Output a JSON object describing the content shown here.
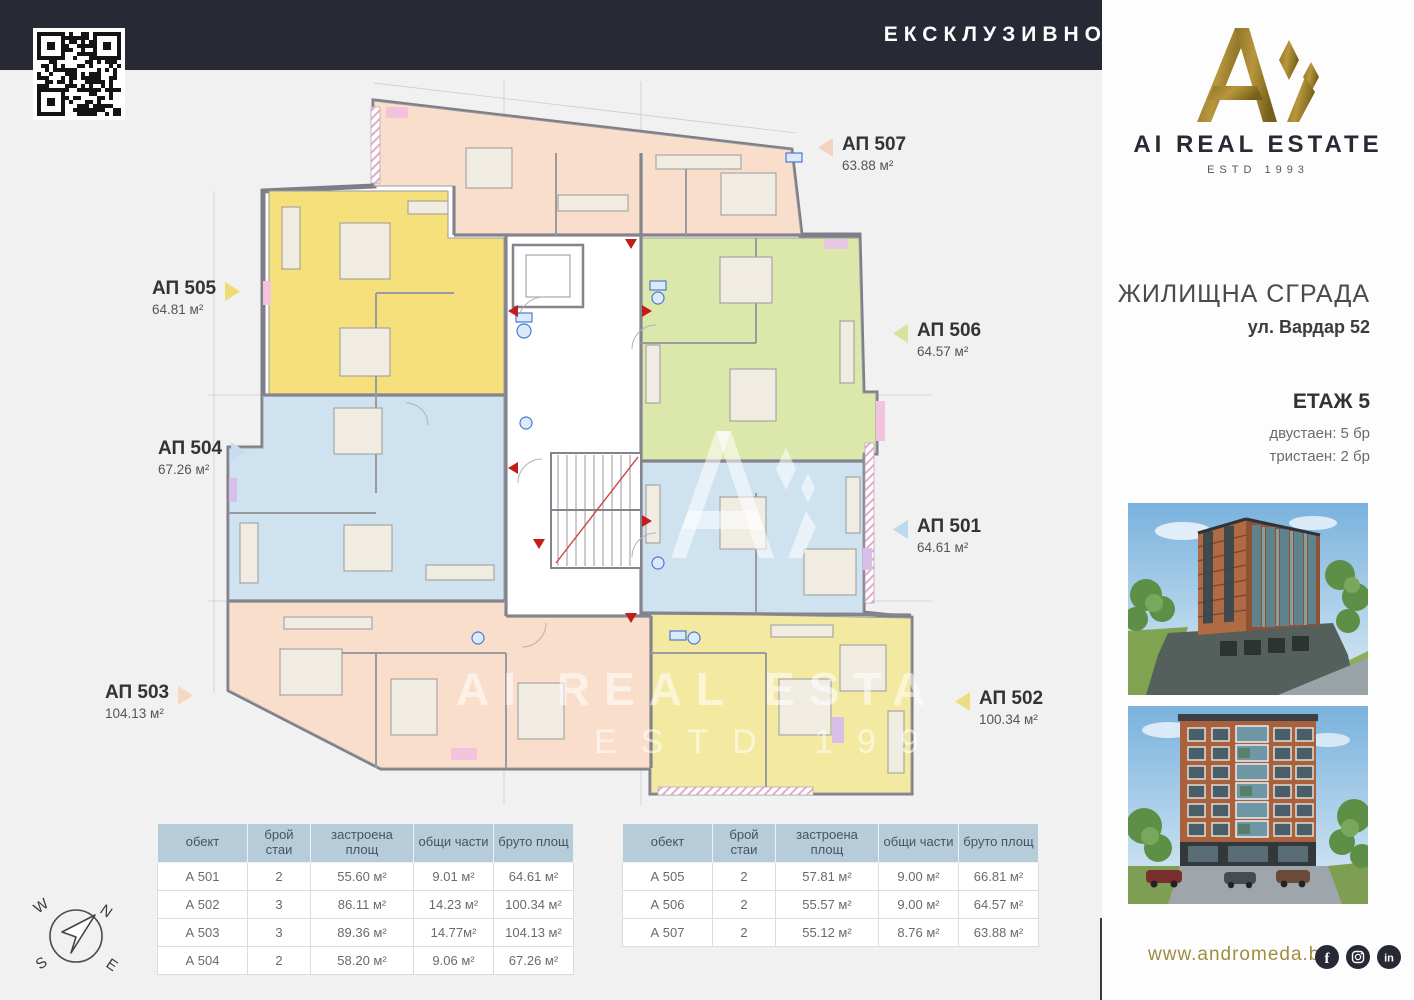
{
  "header": {
    "exclusive": "ЕКСКЛУЗИВНО ОТ"
  },
  "brand": {
    "name": "AI REAL ESTATE",
    "estd": "ESTD 1993",
    "gold": "#9a7d2c",
    "navy": "#272935"
  },
  "project": {
    "building": "ЖИЛИЩНА СГРАДА",
    "address": "ул. Вардар 52",
    "floor": "ЕТАЖ 5",
    "mix": [
      {
        "label": "двустаен: 5 бр"
      },
      {
        "label": "тристаен: 2 бр"
      }
    ]
  },
  "apartments": [
    {
      "id": "АП 507",
      "area": "63.88 м²",
      "color": "#f2d4be",
      "zone": "#f9decb"
    },
    {
      "id": "АП 505",
      "area": "64.81 м²",
      "color": "#f0dc72",
      "zone": "#f5e07c"
    },
    {
      "id": "АП 504",
      "area": "67.26 м²",
      "color": "#c6dcee",
      "zone": "#cfe2ef"
    },
    {
      "id": "АП 503",
      "area": "104.13 м²",
      "color": "#f4d8c2",
      "zone": "#f9decb"
    },
    {
      "id": "АП 506",
      "area": "64.57 м²",
      "color": "#d9e19c",
      "zone": "#dbe7ab"
    },
    {
      "id": "АП 501",
      "area": "64.61 м²",
      "color": "#bed8ec",
      "zone": "#cfe2ef"
    },
    {
      "id": "АП 502",
      "area": "100.34 м²",
      "color": "#ecdc84",
      "zone": "#f3e9a0"
    }
  ],
  "tables": [
    {
      "headers": [
        "обект",
        "брой стаи",
        "застроена площ",
        "общи части",
        "бруто площ"
      ],
      "rows": [
        [
          "А 501",
          "2",
          "55.60 м²",
          "9.01 м²",
          "64.61 м²"
        ],
        [
          "А 502",
          "3",
          "86.11 м²",
          "14.23 м²",
          "100.34 м²"
        ],
        [
          "А 503",
          "3",
          "89.36 м²",
          "14.77м²",
          "104.13 м²"
        ],
        [
          "А 504",
          "2",
          "58.20 м²",
          "9.06 м²",
          "67.26 м²"
        ]
      ]
    },
    {
      "headers": [
        "обект",
        "брой стаи",
        "застроена площ",
        "общи части",
        "бруто площ"
      ],
      "rows": [
        [
          "А 505",
          "2",
          "57.81 м²",
          "9.00 м²",
          "66.81 м²"
        ],
        [
          "А 506",
          "2",
          "55.57 м²",
          "9.00 м²",
          "64.57 м²"
        ],
        [
          "А 507",
          "2",
          "55.12 м²",
          "8.76 м²",
          "63.88 м²"
        ]
      ]
    }
  ],
  "watermark": {
    "name": "AI REAL ESTATE",
    "estd": "ESTD 1993"
  },
  "compass": {
    "n": "N",
    "e": "E",
    "s": "S",
    "w": "W"
  },
  "footer": {
    "website": "www.andromeda.bg",
    "socials": [
      {
        "name": "facebook"
      },
      {
        "name": "instagram"
      },
      {
        "name": "linkedin"
      }
    ]
  }
}
